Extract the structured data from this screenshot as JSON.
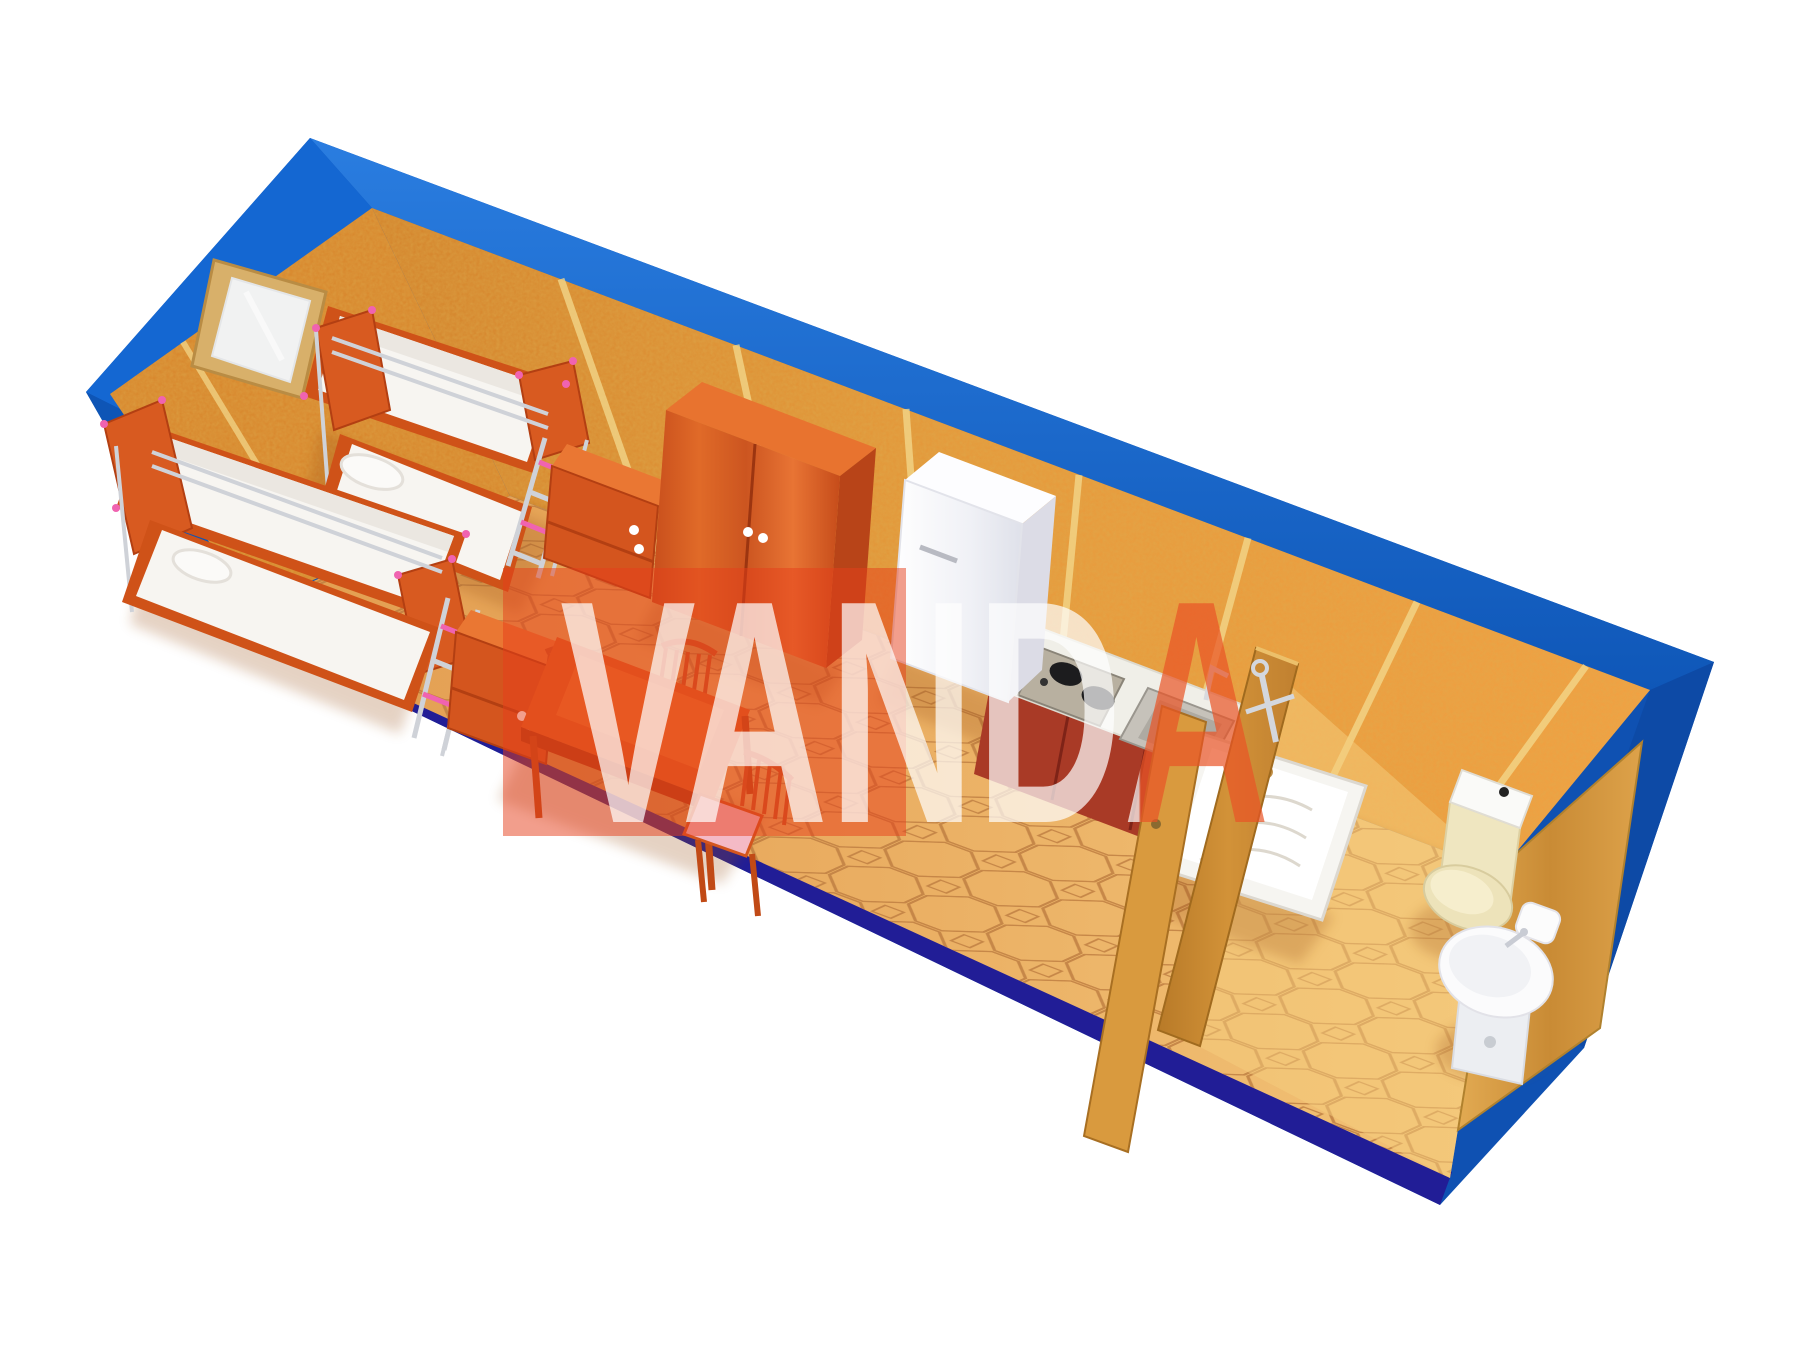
{
  "image": {
    "width": 1800,
    "height": 1350,
    "background_color": "#ffffff",
    "description": "3D cutaway top view render of a blue modular container cabin interior with bunk beds, wardrobe, dining set, kitchenette and bathroom"
  },
  "watermark": {
    "text": "VANDA",
    "box_color": "#e63e1a",
    "letter_color_over_box": "#ffffff",
    "letter_color_outside_box": "#ea5426"
  },
  "palette": {
    "shell_blue": "#1159bf",
    "shell_blue_light": "#2a7de0",
    "shell_blue_dark": "#0d4aa6",
    "shell_navy_edge": "#211d96",
    "wall_osb_orange": "#e59a3c",
    "wall_seam_yellow": "#f4da8e",
    "floor_tile_tan": "#e9ad61",
    "floor_tile_line": "#bd7c40",
    "bathroom_floor": "#f5cd7e",
    "furniture_orange": "#d4551e",
    "furniture_orange_dark": "#b84418",
    "bedding_white": "#f7f5f1",
    "chrome": "#cfd2d8",
    "ladder_pink": "#f063b0",
    "fridge_white": "#f2f3f7",
    "kitchen_cabinet_red": "#a93a26",
    "partition_wood": "#c8872f",
    "sanitary_cream": "#ece1b8",
    "sanitary_white": "#f4f4f6"
  },
  "scene": {
    "rooms": [
      "sleeping and dining area",
      "kitchen corner",
      "bathroom"
    ],
    "objects": [
      {
        "name": "window"
      },
      {
        "name": "bunk-bed-back"
      },
      {
        "name": "bunk-bed-front"
      },
      {
        "name": "nightstand-1"
      },
      {
        "name": "nightstand-2"
      },
      {
        "name": "wardrobe"
      },
      {
        "name": "dining-table"
      },
      {
        "name": "chair-1"
      },
      {
        "name": "chair-2"
      },
      {
        "name": "chair-3"
      },
      {
        "name": "refrigerator"
      },
      {
        "name": "gas-hob"
      },
      {
        "name": "kitchen-sink"
      },
      {
        "name": "kitchen-cabinet"
      },
      {
        "name": "partition-door"
      },
      {
        "name": "shower-mixer"
      },
      {
        "name": "shower-tray"
      },
      {
        "name": "toilet"
      },
      {
        "name": "pedestal-basin"
      },
      {
        "name": "end-wood-panel"
      }
    ]
  }
}
